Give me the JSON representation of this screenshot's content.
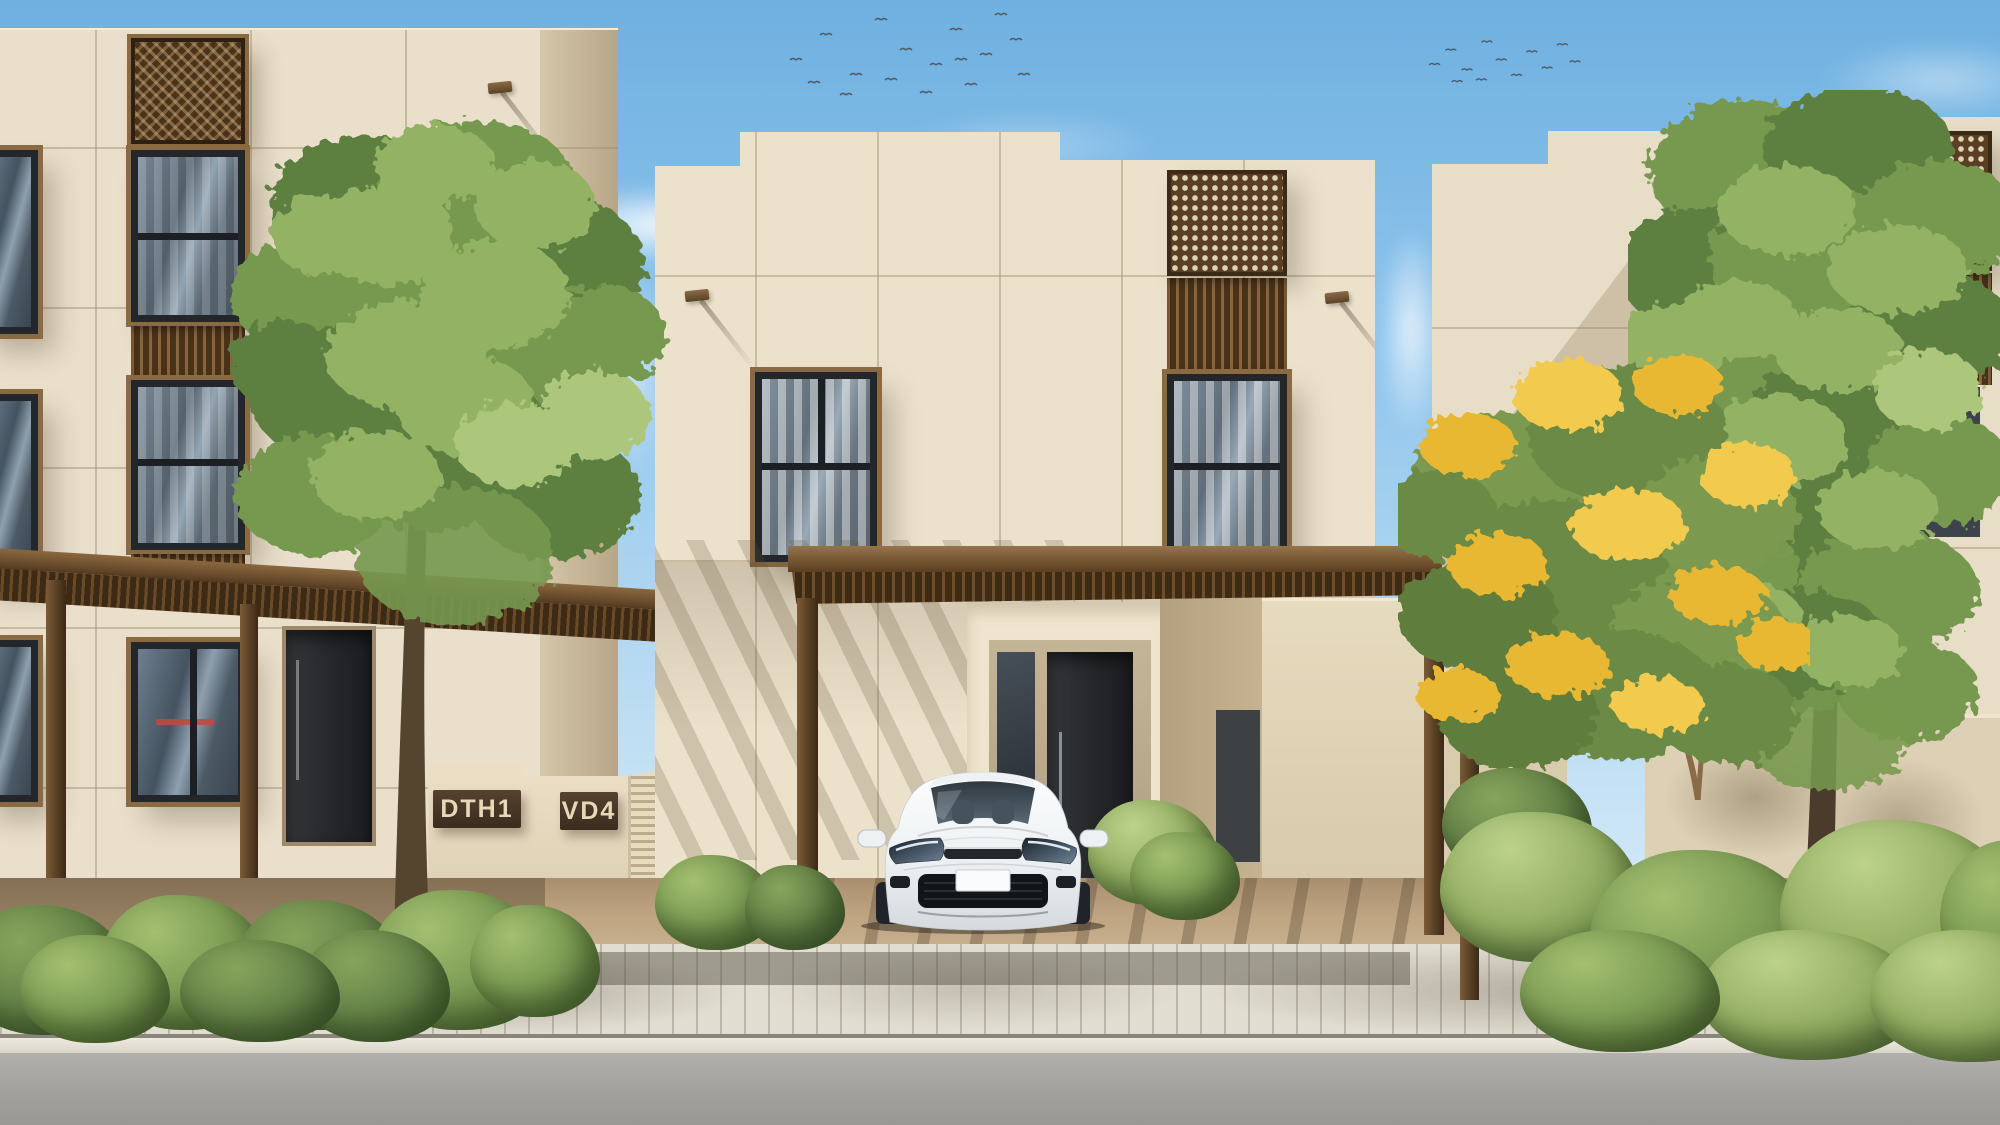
{
  "scene": {
    "type": "architectural-street-render",
    "description": "Daytime street view of a modern beige townhouse community: three flat-roofed villas with wooden lattice screens, a brown carport pergola sheltering a white parked car, green trees (one with yellow blossoms), hedges, a paved sidewalk and an asphalt road in the foreground",
    "time_of_day": "day",
    "sky": {
      "top_color": "#6fb0e0",
      "horizon_color": "#e2f1fb",
      "cloud_count": 6,
      "bird_flocks": [
        {
          "count": 17
        },
        {
          "count": 12
        }
      ]
    }
  },
  "signs": {
    "left_unit": "DTH1",
    "right_unit": "VD4"
  },
  "vehicle": {
    "type": "white-hatchback",
    "body_color": "#f2f4f6",
    "license_plate": "",
    "position": "parked under carport"
  },
  "buildings": {
    "left": {
      "name": "townhouse-left",
      "floors": 3,
      "facade_color": "#e9dfca",
      "features": [
        "diagonal-weave-lattice",
        "vertical-slat-screens",
        "dark-frame-windows",
        "entry-door",
        "address-signs",
        "ac-louver-enclosure",
        "street-pergola"
      ]
    },
    "center": {
      "name": "villa-center",
      "floors": 2,
      "facade_color": "#ece2cc",
      "features": [
        "stepped-parapet",
        "perforated-lattice-panel",
        "slat-panel",
        "curtained-windows",
        "wall-lamps",
        "recessed-entrance",
        "carport-pergola"
      ]
    },
    "right": {
      "name": "townhouse-right",
      "floors": 3,
      "facade_color": "#e8ddc6",
      "features": [
        "stepped-parapet",
        "perforated-lattice-screen",
        "slat-panel",
        "garden-wall",
        "carport-pergola"
      ]
    }
  },
  "landscape": {
    "tree_count": 3,
    "flowering_tree_color": "#e9b832",
    "hedge_color": "#74944f"
  },
  "ground": {
    "sidewalk_color": "#e1ddd0",
    "curb_color": "#eeeadf",
    "road_color": "#a9a7a3",
    "soil_color": "#b49a79"
  },
  "palette": {
    "facade": "#e9dfca",
    "facade_shadow": "#c7b698",
    "wood_dark": "#4a331b",
    "wood_mid": "#7f5f3a",
    "window_frame": "#23262a",
    "glass": "#55687a",
    "curtain": "#eef0f1",
    "sign_bg": "#3b2c1f",
    "sign_text": "#e6d9ba",
    "foliage_dark": "#55793c",
    "foliage_light": "#93b264",
    "blossom": "#e9b832",
    "bird": "#4f5e6a"
  }
}
